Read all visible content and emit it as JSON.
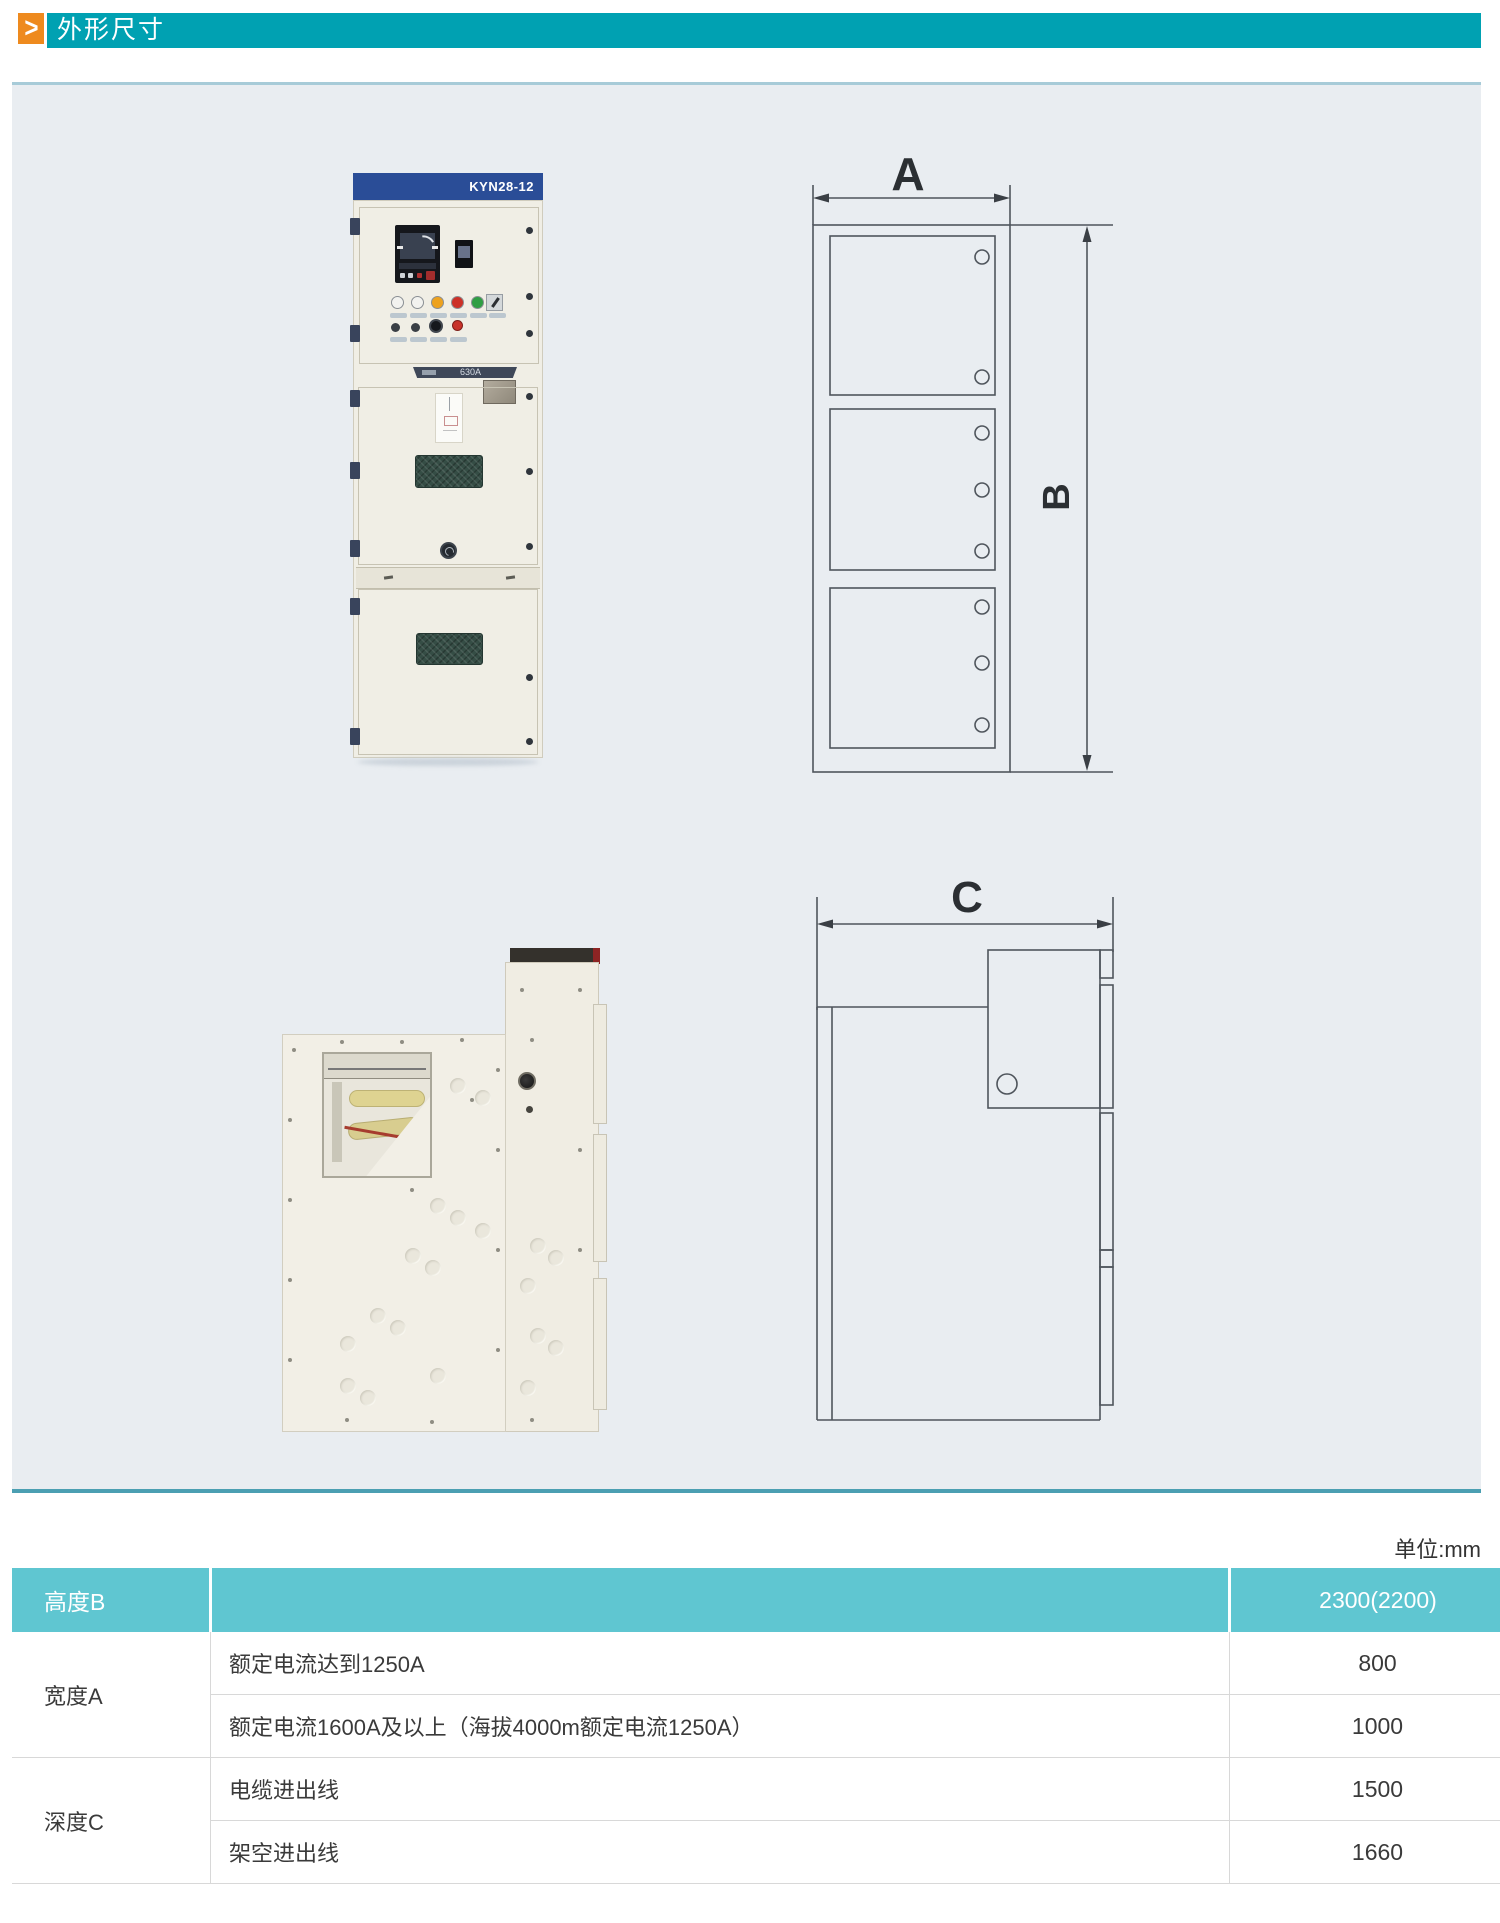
{
  "header": {
    "arrow_glyph": ">",
    "title": "外形尺寸"
  },
  "colors": {
    "accent_orange": "#ee8a1e",
    "header_teal": "#00a1b2",
    "panel_background": "#e9edf1",
    "table_header_teal": "#5fc6d1",
    "cabinet_band_blue": "#2a4d97"
  },
  "front_photo": {
    "model_label": "KYN28-12",
    "breaker_label": "630A",
    "indicator_lamp_colors": [
      "#f2f2ef",
      "#f2f2ef",
      "#eda21f",
      "#cc3128",
      "#2f9e44"
    ]
  },
  "dimension_labels": {
    "width": "A",
    "height": "B",
    "depth": "C"
  },
  "unit_note": "单位:mm",
  "table": {
    "header_row": {
      "label": "高度B",
      "desc": "",
      "value": "2300(2200)"
    },
    "body": [
      {
        "group": "宽度A",
        "desc": "额定电流达到1250A",
        "value": "800"
      },
      {
        "desc": "额定电流1600A及以上（海拔4000m额定电流1250A）",
        "value": "1000"
      },
      {
        "group": "深度C",
        "desc": "电缆进出线",
        "value": "1500"
      },
      {
        "desc": "架空进出线",
        "value": "1660"
      }
    ]
  }
}
